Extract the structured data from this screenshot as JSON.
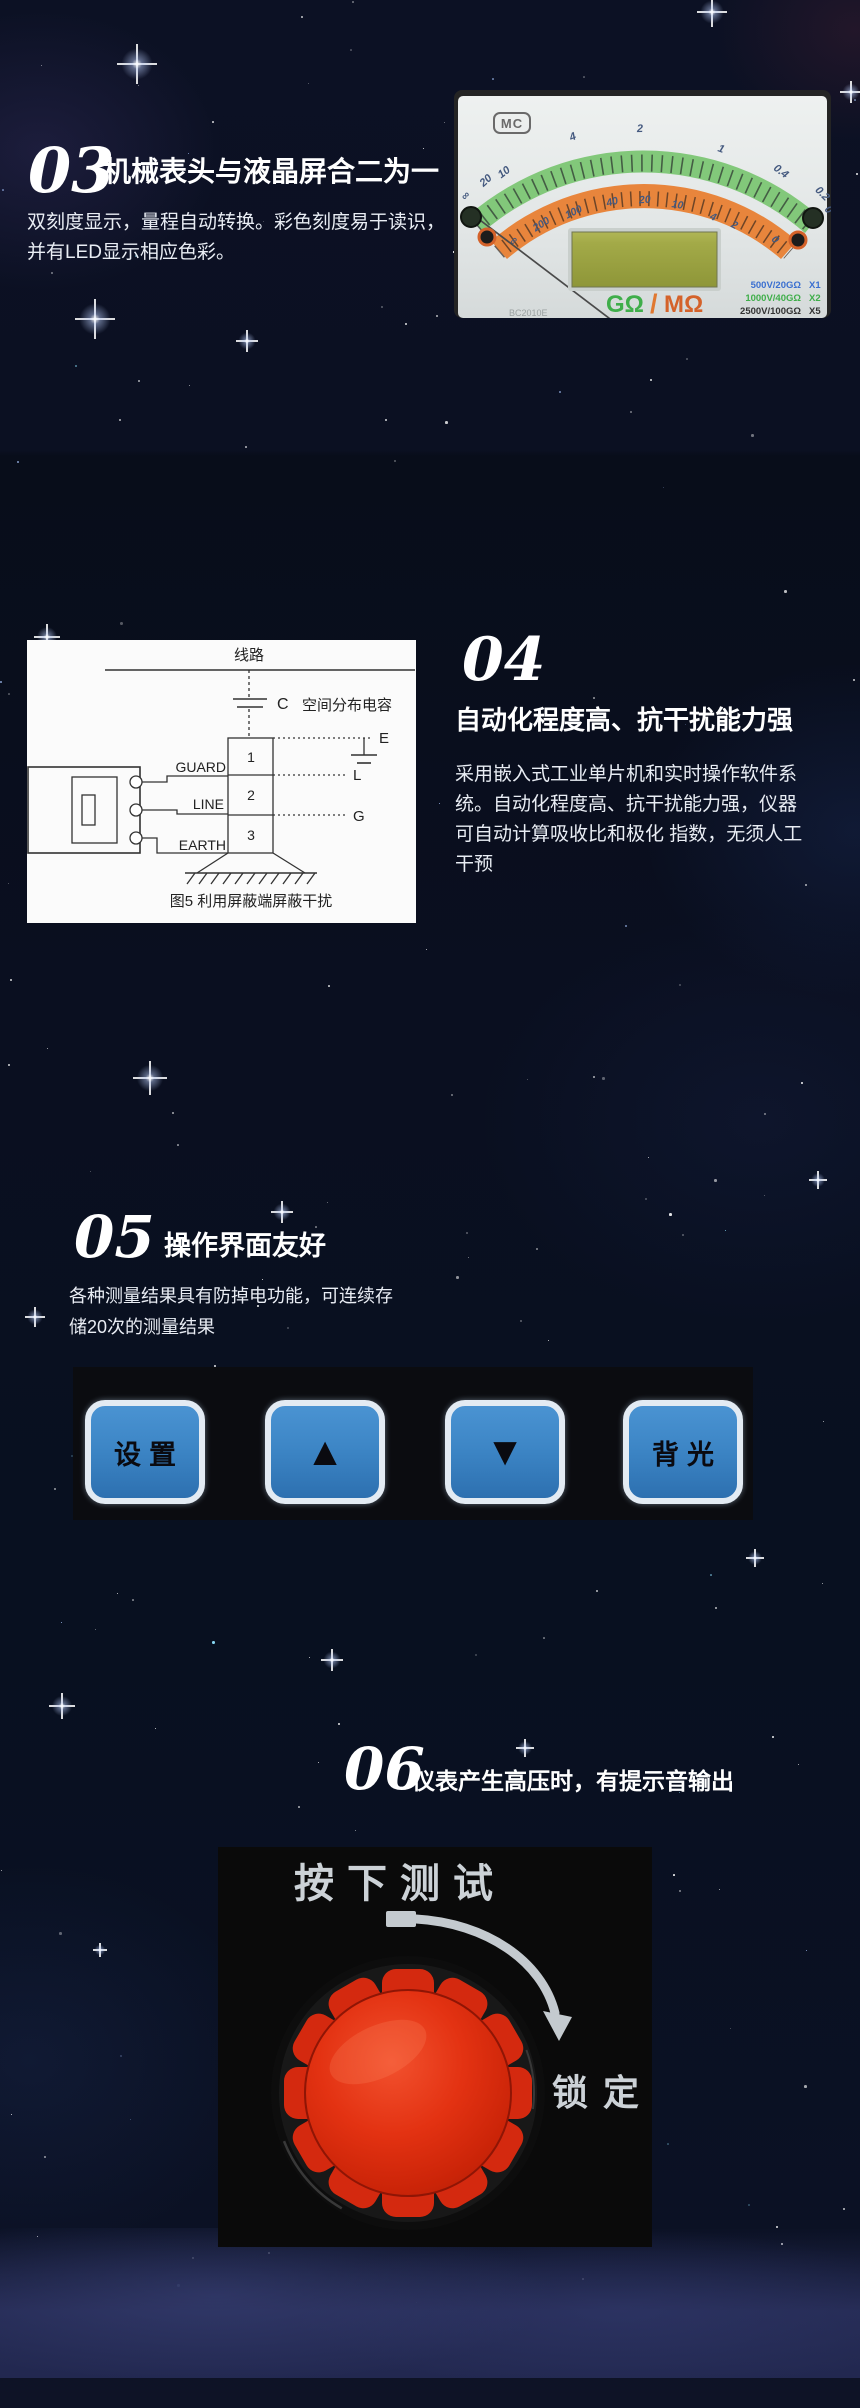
{
  "s03": {
    "number": "03",
    "title": "机械表头与液晶屏合二为一",
    "body_line1": "双刻度显示，量程自动转换。彩色刻度易于读识，",
    "body_line2": "并有LED显示相应色彩。",
    "meter": {
      "logo": "MC",
      "green_scale": [
        "∞",
        "20",
        "10",
        "4",
        "2",
        "1",
        "0.4",
        "0.2",
        "0"
      ],
      "orange_scale": [
        "∞",
        "200",
        "100",
        "40",
        "20",
        "10",
        "4",
        "2",
        "0"
      ],
      "unit_green": "GΩ",
      "unit_sep": "/",
      "unit_orange": "MΩ",
      "ranges": [
        {
          "label": "500V/20GΩ",
          "mult": "X1",
          "color": "#3a6fd0"
        },
        {
          "label": "1000V/40GΩ",
          "mult": "X2",
          "color": "#3fae4a"
        },
        {
          "label": "2500V/100GΩ",
          "mult": "X5",
          "color": "#333333"
        },
        {
          "label": "5000V/200GΩ",
          "mult": "X10",
          "color": "#e07830"
        }
      ],
      "model": "BC2010E",
      "sub_range": "4GΩ—1000MΩ"
    }
  },
  "s04": {
    "number": "04",
    "title": "自动化程度高、抗干扰能力强",
    "body_line1": "采用嵌入式工业单片机和实时操作软件系",
    "body_line2": "统。自动化程度高、抗干扰能力强，仪器",
    "body_line3": "可自动计算吸收比和极化 指数，无须人工",
    "body_line4": "干预",
    "diagram": {
      "top_label": "线路",
      "cap_symbol": "C",
      "cap_desc": "空间分布电容",
      "terminals": [
        "GUARD",
        "LINE",
        "EARTH"
      ],
      "cells": [
        "1",
        "2",
        "3"
      ],
      "right_labels": [
        "E",
        "L",
        "G"
      ],
      "caption": "图5   利用屏蔽端屏蔽干扰"
    }
  },
  "s05": {
    "number": "05",
    "title": "操作界面友好",
    "body_line1": "各种测量结果具有防掉电功能，可连续存",
    "body_line2": "储20次的测量结果",
    "buttons": [
      {
        "label": "设置"
      },
      {
        "label": "▲"
      },
      {
        "label": "▼"
      },
      {
        "label": "背光"
      }
    ]
  },
  "s06": {
    "number": "06",
    "title": "仪表产生高压时，有提示音输出",
    "knob": {
      "top_label": "按下测试",
      "side_label": "锁定"
    }
  }
}
